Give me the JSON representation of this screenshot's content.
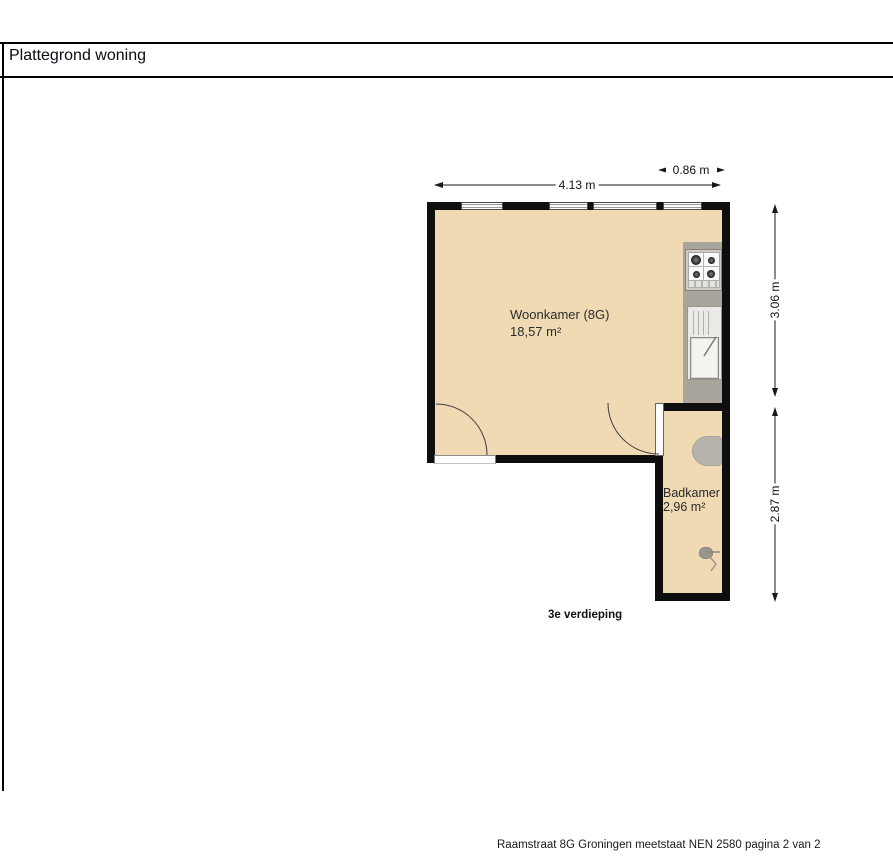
{
  "page": {
    "title": "Plattegrond woning",
    "footer": "Raamstraat 8G Groningen meetstaat NEN 2580 pagina 2 van 2"
  },
  "plan": {
    "floor_label": "3e verdieping",
    "rooms": [
      {
        "name": "Woonkamer (8G)",
        "area": "18,57 m²"
      },
      {
        "name": "Badkamer",
        "area": "2,96 m²"
      }
    ],
    "dimensions": {
      "width_main": "4.13 m",
      "width_right": "0.86 m",
      "height_upper": "3.06 m",
      "height_lower": "2.87 m"
    },
    "colors": {
      "floor": "#efdab4",
      "wall": "#0e0e0e",
      "kitchen_counter": "#aaa59c",
      "fixture_gray": "#b6b3ad"
    }
  }
}
